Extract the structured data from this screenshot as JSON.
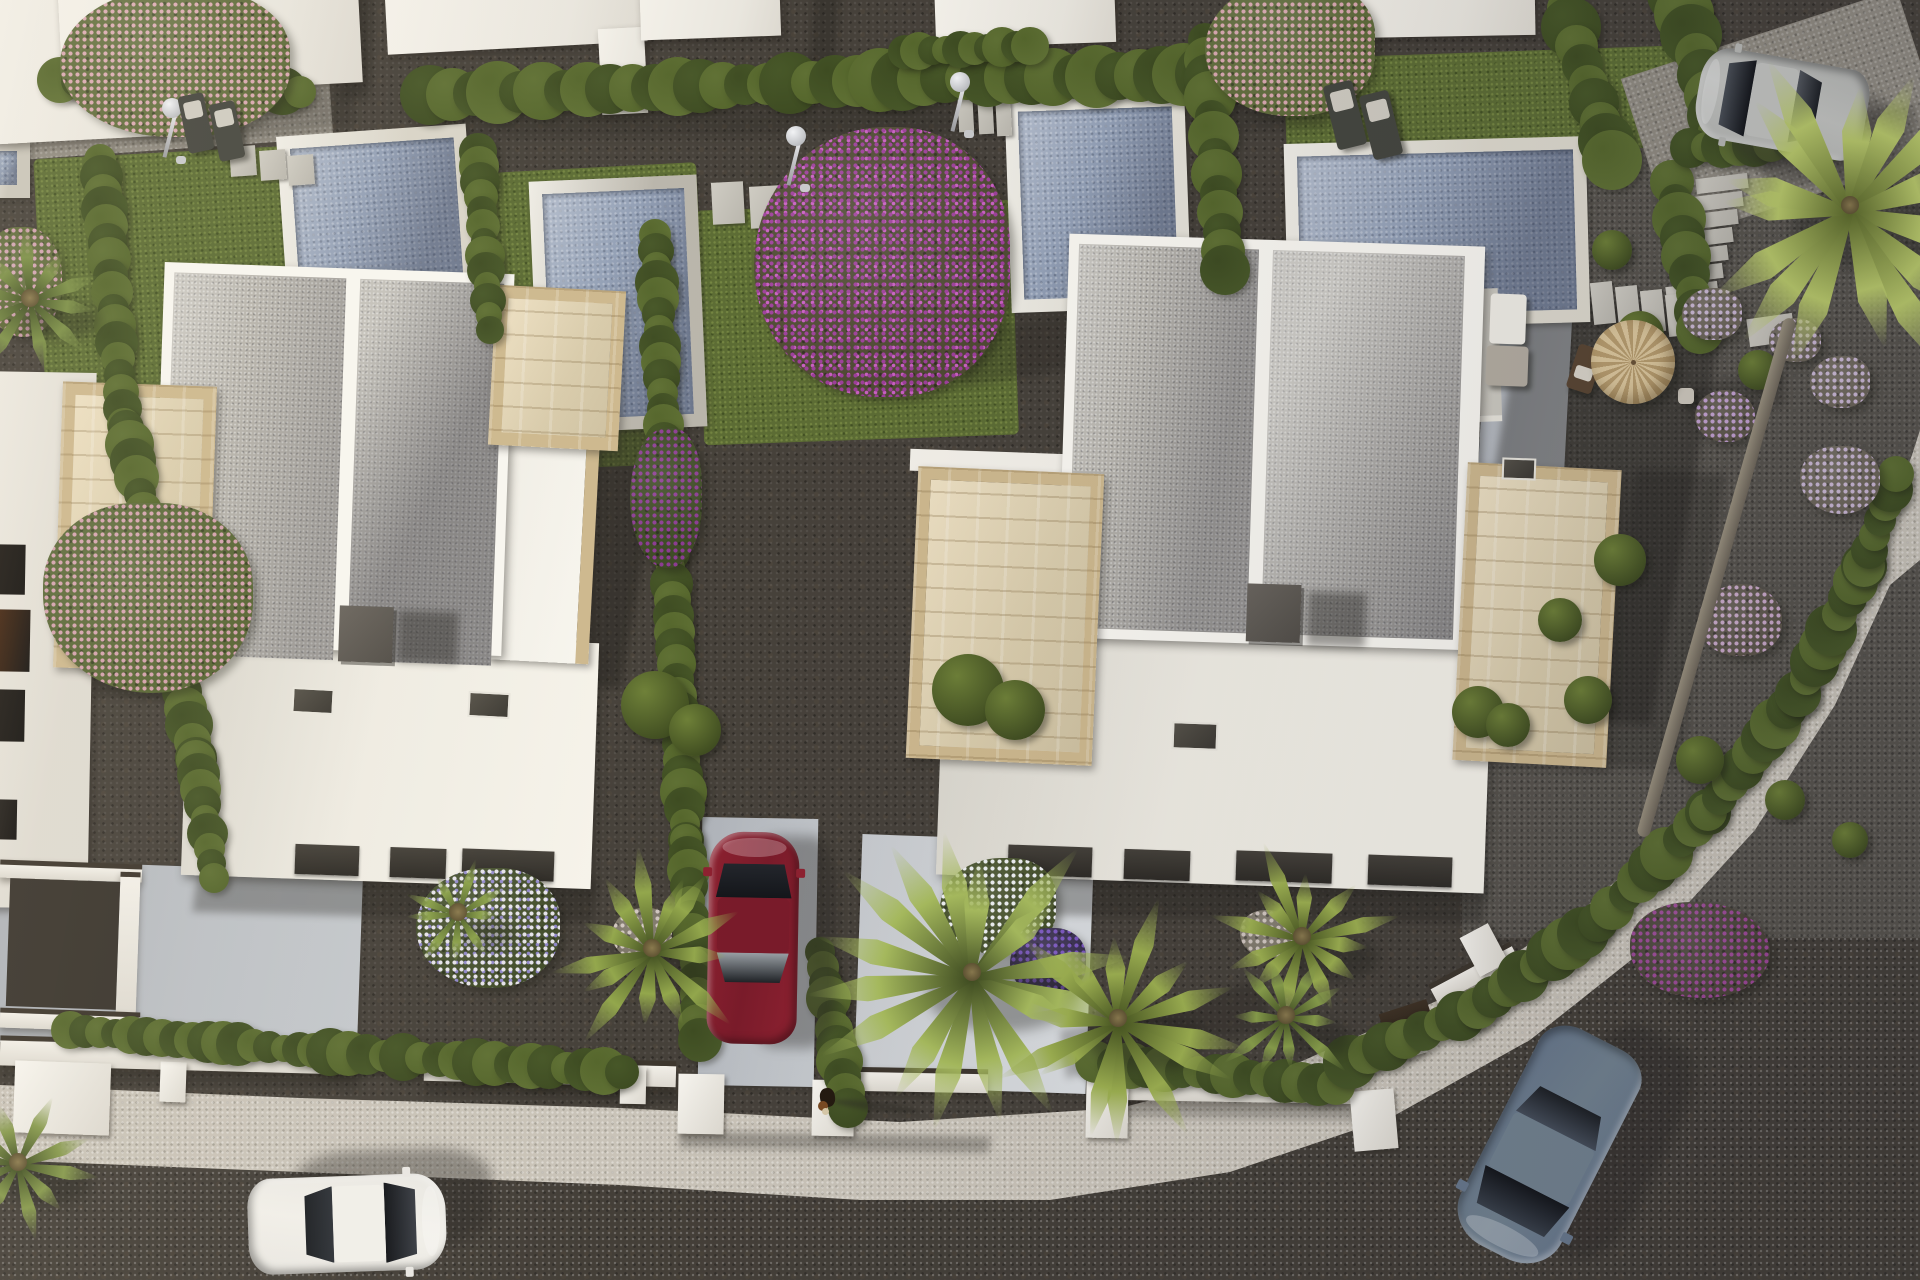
{
  "scene": {
    "title": "aerial-3d-render-of-white-villas-with-pools",
    "width": 1920,
    "height": 1280
  },
  "palette": {
    "gravel_dark": "#46413a",
    "grass": "#5c6c34",
    "road": "#b0aba3",
    "sidewalk": "#c9c3b8",
    "villa_white": "#f8f6f0",
    "roof_gravel": "#b7b4ad",
    "travertine": "#cfba90",
    "pool_water": "#93a0b6",
    "pool_coping": "#d8d4c8",
    "hedge_green": "#4c5a2b",
    "car_red": "#8e2130",
    "car_white": "#e9e7e2",
    "car_blue": "#68788c",
    "car_silver": "#b6b7b3",
    "parasol": "#d2ba8e",
    "chimney": "#57534c"
  },
  "patches": [
    {
      "c": "grass",
      "x": 40,
      "y": 148,
      "w": 420,
      "h": 272,
      "r": -3
    },
    {
      "c": "grass",
      "x": 468,
      "y": 168,
      "w": 235,
      "h": 262,
      "r": -3
    },
    {
      "c": "grass",
      "x": 700,
      "y": 205,
      "w": 315,
      "h": 235,
      "r": -2
    },
    {
      "c": "grass",
      "x": 470,
      "y": 398,
      "w": 205,
      "h": 70,
      "r": -2
    },
    {
      "c": "grass",
      "x": 1288,
      "y": 52,
      "w": 400,
      "h": 272,
      "r": -2
    },
    {
      "c": "grass",
      "x": 1370,
      "y": 358,
      "w": 320,
      "h": 112,
      "r": -2
    },
    {
      "c": "grass",
      "x": 1492,
      "y": 296,
      "w": 95,
      "h": 78,
      "r": -2
    },
    {
      "c": "pale-path",
      "x": -10,
      "y": 42,
      "w": 340,
      "h": 108,
      "r": -4
    },
    {
      "c": "gravel-light",
      "x": 1462,
      "y": 148,
      "w": 470,
      "h": 790,
      "r": 0
    },
    {
      "c": "pale-path",
      "x": 1640,
      "y": 30,
      "w": 290,
      "h": 170,
      "r": -18
    },
    {
      "c": "drive",
      "x": -12,
      "y": 866,
      "w": 372,
      "h": 182,
      "r": 2
    },
    {
      "c": "drive",
      "x": 700,
      "y": 818,
      "w": 116,
      "h": 268,
      "r": 1
    },
    {
      "c": "drive-bright",
      "x": 858,
      "y": 838,
      "w": 232,
      "h": 252,
      "r": 2
    },
    {
      "c": "drive",
      "x": 1478,
      "y": 298,
      "w": 86,
      "h": 350,
      "r": 3
    }
  ],
  "pools": [
    {
      "x": 282,
      "y": 130,
      "w": 190,
      "h": 178,
      "r": -4,
      "coping": "#d8d4c8"
    },
    {
      "x": 534,
      "y": 178,
      "w": 168,
      "h": 252,
      "r": -2.5,
      "coping": "#b9b5ab"
    },
    {
      "x": 1008,
      "y": 96,
      "w": 180,
      "h": 214,
      "r": -2,
      "coping": "#e3e0d6"
    },
    {
      "x": 1286,
      "y": 140,
      "w": 302,
      "h": 186,
      "r": -1.5,
      "coping": "#ddd9cd"
    },
    {
      "x": -18,
      "y": 138,
      "w": 48,
      "h": 60,
      "r": 0,
      "coping": "#c9c5ba"
    }
  ],
  "pool_deck": {
    "x": 1278,
    "y": 292,
    "w": 222,
    "h": 133,
    "r": -2
  },
  "hedges": [
    [
      60,
      80,
      300,
      92,
      20
    ],
    [
      430,
      95,
      880,
      80,
      26
    ],
    [
      880,
      80,
      1335,
      72,
      26
    ],
    [
      905,
      52,
      1030,
      46,
      17
    ],
    [
      1565,
      8,
      1612,
      160,
      24
    ],
    [
      1678,
      -6,
      1722,
      136,
      26
    ],
    [
      1672,
      182,
      1700,
      330,
      22
    ],
    [
      1205,
      40,
      1225,
      270,
      22
    ],
    [
      100,
      160,
      124,
      425,
      19
    ],
    [
      126,
      428,
      196,
      758,
      20
    ],
    [
      196,
      760,
      214,
      878,
      18
    ],
    [
      478,
      152,
      490,
      330,
      17
    ],
    [
      655,
      235,
      668,
      520,
      19
    ],
    [
      668,
      520,
      686,
      840,
      19
    ],
    [
      686,
      840,
      700,
      1040,
      18
    ],
    [
      820,
      952,
      848,
      1108,
      19
    ],
    [
      70,
      1030,
      330,
      1052,
      18
    ],
    [
      330,
      1052,
      622,
      1072,
      21
    ],
    [
      1096,
      1062,
      1336,
      1086,
      21
    ],
    [
      1350,
      1062,
      1478,
      1008,
      22
    ],
    [
      1478,
      1008,
      1598,
      922,
      22
    ],
    [
      1598,
      922,
      1708,
      812,
      22
    ],
    [
      1708,
      812,
      1798,
      694,
      22
    ],
    [
      1798,
      694,
      1864,
      566,
      22
    ],
    [
      1864,
      566,
      1896,
      474,
      20
    ],
    [
      1690,
      148,
      1852,
      140,
      19
    ]
  ],
  "bushes": [
    [
      968,
      690,
      36
    ],
    [
      1015,
      710,
      30
    ],
    [
      655,
      705,
      34
    ],
    [
      695,
      730,
      26
    ],
    [
      1478,
      712,
      26
    ],
    [
      1508,
      725,
      22
    ],
    [
      1588,
      700,
      24
    ],
    [
      1640,
      335,
      24
    ],
    [
      1758,
      370,
      20
    ],
    [
      1620,
      560,
      26
    ],
    [
      1560,
      620,
      22
    ],
    [
      1700,
      760,
      24
    ],
    [
      1785,
      800,
      20
    ],
    [
      1850,
      840,
      18
    ],
    [
      1612,
      250,
      20
    ]
  ],
  "beds": [
    {
      "x": 175,
      "y": 62,
      "rx": 115,
      "ry": 75,
      "base": "#5f6b3a",
      "dot": "#d9a8b0"
    },
    {
      "x": 148,
      "y": 598,
      "rx": 105,
      "ry": 95,
      "base": "#566433",
      "dot": "#d2a0ac"
    },
    {
      "x": 882,
      "y": 262,
      "rx": 128,
      "ry": 135,
      "base": "#4f4a33",
      "dot": "#9d3f9a",
      "dot2": "#c95fc2"
    },
    {
      "x": 666,
      "y": 498,
      "rx": 36,
      "ry": 70,
      "base": "#3e4a26",
      "dot": "#8b3b92"
    },
    {
      "x": 1290,
      "y": 48,
      "rx": 85,
      "ry": 68,
      "base": "#5f6b3a",
      "dot": "#d8a6ae"
    },
    {
      "x": 488,
      "y": 928,
      "rx": 72,
      "ry": 60,
      "base": "#424d2a",
      "dot": "#e6e3ea",
      "dot2": "#8f86c9"
    },
    {
      "x": 998,
      "y": 906,
      "rx": 58,
      "ry": 48,
      "base": "#47522c",
      "dot": "#eef0f2"
    },
    {
      "x": 1048,
      "y": 962,
      "rx": 38,
      "ry": 34,
      "base": "#3a3050",
      "dot": "#7a55c0"
    },
    {
      "x": 1712,
      "y": 314,
      "rx": 30,
      "ry": 26,
      "base": "#6b6458",
      "dot": "#c9b6d2"
    },
    {
      "x": 1795,
      "y": 340,
      "rx": 26,
      "ry": 22,
      "base": "#6b6458",
      "dot": "#c9b6d2"
    },
    {
      "x": 1840,
      "y": 382,
      "rx": 30,
      "ry": 26,
      "base": "#6b6458",
      "dot": "#c9b6d2"
    },
    {
      "x": 1725,
      "y": 416,
      "rx": 30,
      "ry": 26,
      "base": "#5c5549",
      "dot": "#c29fd0"
    },
    {
      "x": 1840,
      "y": 480,
      "rx": 40,
      "ry": 34,
      "base": "#6b6458",
      "dot": "#c9b6d2"
    },
    {
      "x": 1740,
      "y": 620,
      "rx": 42,
      "ry": 36,
      "base": "#5c5549",
      "dot": "#c9a8c8"
    },
    {
      "x": 1700,
      "y": 950,
      "rx": 70,
      "ry": 48,
      "base": "#4a4438",
      "dot": "#9c4796"
    },
    {
      "x": 642,
      "y": 934,
      "rx": 30,
      "ry": 26,
      "base": "#7d7668",
      "dot": "#cfc4bd"
    },
    {
      "x": 1268,
      "y": 934,
      "rx": 28,
      "ry": 24,
      "base": "#7d7668",
      "dot": "#cfc4bd"
    },
    {
      "x": 22,
      "y": 282,
      "rx": 40,
      "ry": 55,
      "base": "#5a6535",
      "dot": "#cf9fae"
    }
  ],
  "palms": [
    {
      "x": 972,
      "y": 972,
      "r": 150,
      "n": 16,
      "c1": "#3f4c20",
      "c2": "#a8bc5e"
    },
    {
      "x": 1118,
      "y": 1018,
      "r": 118,
      "n": 14,
      "c1": "#46541f",
      "c2": "#9db050"
    },
    {
      "x": 652,
      "y": 948,
      "r": 100,
      "n": 13,
      "c1": "#3f4c20",
      "c2": "#93a74c"
    },
    {
      "x": 1850,
      "y": 205,
      "r": 175,
      "n": 15,
      "c1": "#5c6a2a",
      "c2": "#b9c96a",
      "z": 14
    },
    {
      "x": 1302,
      "y": 936,
      "r": 92,
      "n": 12,
      "c1": "#46541f",
      "c2": "#9db050"
    },
    {
      "x": 1286,
      "y": 1015,
      "r": 70,
      "n": 10,
      "c1": "#3f4c20",
      "c2": "#8aa04b"
    },
    {
      "x": 30,
      "y": 298,
      "r": 80,
      "n": 10,
      "c1": "#3c4a21",
      "c2": "#7b8f47"
    },
    {
      "x": 18,
      "y": 1162,
      "r": 85,
      "n": 10,
      "c1": "#3c4a21",
      "c2": "#86994d"
    },
    {
      "x": 458,
      "y": 912,
      "r": 55,
      "n": 9,
      "c1": "#4a5a28",
      "c2": "#8aa04b"
    }
  ],
  "trunk": {
    "x": 1710,
    "y": 308,
    "w": 13,
    "h": 539,
    "rot": 16
  },
  "slabs": [
    [
      230,
      146,
      26,
      30,
      -4
    ],
    [
      260,
      150,
      26,
      30,
      -4
    ],
    [
      288,
      155,
      26,
      30,
      -4
    ],
    [
      712,
      182,
      32,
      42,
      -3
    ],
    [
      750,
      186,
      30,
      42,
      -3
    ],
    [
      958,
      86,
      15,
      46,
      -3
    ],
    [
      978,
      88,
      15,
      46,
      -3
    ],
    [
      996,
      90,
      15,
      46,
      -3
    ],
    [
      1696,
      176,
      52,
      15,
      -7
    ],
    [
      1691,
      194,
      52,
      15,
      -7
    ],
    [
      1686,
      212,
      52,
      15,
      -7
    ],
    [
      1681,
      230,
      52,
      15,
      -7
    ],
    [
      1676,
      248,
      52,
      15,
      -7
    ],
    [
      1671,
      266,
      52,
      15,
      -7
    ],
    [
      1666,
      284,
      52,
      15,
      -7
    ],
    [
      1592,
      282,
      22,
      42,
      -6
    ],
    [
      1617,
      286,
      22,
      42,
      -6
    ],
    [
      1642,
      290,
      22,
      42,
      -6
    ],
    [
      1667,
      294,
      22,
      42,
      -6
    ],
    [
      1748,
      316,
      46,
      28,
      -8
    ]
  ],
  "walls": [
    [
      0,
      1040,
      352,
      30,
      1.5
    ],
    [
      424,
      1058,
      252,
      26,
      1.5
    ],
    [
      846,
      1068,
      142,
      24,
      1
    ],
    [
      1122,
      1076,
      232,
      26,
      1
    ],
    [
      1342,
      1040,
      84,
      24,
      -16
    ],
    [
      1428,
      962,
      92,
      22,
      -28
    ],
    [
      0,
      862,
      142,
      18,
      2
    ],
    [
      118,
      872,
      20,
      150,
      2
    ],
    [
      0,
      1010,
      140,
      20,
      2
    ]
  ],
  "piers": [
    [
      14,
      1062,
      96,
      72,
      2
    ],
    [
      160,
      1062,
      26,
      40,
      2
    ],
    [
      620,
      1066,
      26,
      38,
      1
    ],
    [
      678,
      1074,
      46,
      60,
      1
    ],
    [
      812,
      1080,
      42,
      56,
      1
    ],
    [
      1086,
      1080,
      42,
      58,
      1
    ],
    [
      1352,
      1090,
      44,
      60,
      -5
    ],
    [
      1468,
      928,
      32,
      44,
      -28
    ]
  ],
  "gate": {
    "x": 1382,
    "y": 1006,
    "w": 50,
    "h": 30,
    "rot": -18,
    "color": "#3f3224"
  },
  "showers": [
    [
      162,
      104
    ],
    [
      786,
      132
    ],
    [
      950,
      78
    ]
  ],
  "furniture": [
    {
      "t": "lounger",
      "x": 183,
      "y": 94,
      "w": 26,
      "h": 58,
      "rot": -12
    },
    {
      "t": "lounger",
      "x": 214,
      "y": 102,
      "w": 26,
      "h": 58,
      "rot": -12
    },
    {
      "t": "lounger",
      "x": 1330,
      "y": 82,
      "w": 30,
      "h": 66,
      "rot": -14
    },
    {
      "t": "lounger",
      "x": 1366,
      "y": 92,
      "w": 30,
      "h": 66,
      "rot": -14
    },
    {
      "t": "chair",
      "x": 1572,
      "y": 346,
      "w": 26,
      "h": 46,
      "rot": 18
    },
    {
      "t": "table",
      "x": 1678,
      "y": 388,
      "w": 16,
      "h": 16,
      "rot": 0
    },
    {
      "t": "parasol",
      "x": 1591,
      "y": 320,
      "w": 84,
      "h": 84,
      "rot": 0
    },
    {
      "t": "sofa",
      "x": 1490,
      "y": 294,
      "w": 36,
      "h": 50,
      "rot": 2
    },
    {
      "t": "seat",
      "x": 1486,
      "y": 346,
      "w": 42,
      "h": 40,
      "rot": 2
    }
  ],
  "cars": [
    {
      "name": "car-white",
      "cx": 347,
      "cy": 1224,
      "w": 96,
      "h": 198,
      "rot": 88,
      "body": "#e9e7e2",
      "roof": "#f1efe9",
      "glassF": "#3a3e45",
      "glassR": "#2f3339",
      "sdx": 46,
      "sdy": -26
    },
    {
      "name": "car-red",
      "cx": 753,
      "cy": 938,
      "w": 90,
      "h": 212,
      "rot": 1,
      "body": "#8e2130",
      "roof": "#7a1b2a",
      "glassF": "#23262c",
      "glassR": "#9aa0a5",
      "sdx": 40,
      "sdy": 4
    },
    {
      "name": "car-blue",
      "cx": 1548,
      "cy": 1146,
      "w": 112,
      "h": 238,
      "rot": 207,
      "body": "#68788c",
      "roof": "#72828f",
      "glassF": "#39404a",
      "glassR": "#454d59",
      "sdx": 60,
      "sdy": -4
    },
    {
      "name": "car-silver",
      "cx": 1782,
      "cy": 104,
      "w": 92,
      "h": 170,
      "rot": -80,
      "body": "#b6b7b3",
      "roof": "#c3c4c0",
      "glassF": "#4a4f56",
      "glassR": "#53575d",
      "sdx": 34,
      "sdy": 28
    }
  ],
  "dog": {
    "x": 820,
    "y": 1088
  },
  "shadows": [
    [
      505,
      295,
      150,
      390,
      4,
      0.4
    ],
    [
      195,
      875,
      400,
      42,
      1.5,
      0.33
    ],
    [
      1488,
      300,
      200,
      420,
      4,
      0.38
    ],
    [
      1612,
      470,
      90,
      300,
      3,
      0.28
    ],
    [
      945,
      878,
      540,
      40,
      1,
      0.32
    ],
    [
      62,
      668,
      160,
      30,
      2,
      0.28
    ],
    [
      165,
      -5,
      40,
      140,
      -3,
      0.33
    ],
    [
      342,
      -10,
      30,
      110,
      -3,
      0.3
    ],
    [
      812,
      -15,
      26,
      80,
      -2,
      0.3
    ],
    [
      1262,
      -12,
      24,
      70,
      -2,
      0.3
    ],
    [
      430,
      108,
      900,
      26,
      -0.5,
      0.22
    ],
    [
      960,
      318,
      170,
      55,
      -10,
      0.26
    ],
    [
      235,
      95,
      120,
      38,
      -8,
      0.22
    ],
    [
      1690,
      378,
      95,
      36,
      -10,
      0.26
    ],
    [
      1760,
      120,
      160,
      60,
      -12,
      0.28
    ],
    [
      1060,
      1005,
      210,
      48,
      -14,
      0.26
    ],
    [
      0,
      1068,
      360,
      18,
      1.5,
      0.26
    ],
    [
      424,
      1084,
      260,
      16,
      1.5,
      0.26
    ],
    [
      680,
      1134,
      310,
      16,
      1,
      0.3
    ],
    [
      1090,
      1102,
      270,
      16,
      1,
      0.26
    ]
  ],
  "top_blocks": [
    [
      -15,
      -15,
      185,
      155,
      -3
    ],
    [
      60,
      -25,
      300,
      115,
      -3
    ],
    [
      386,
      -18,
      260,
      66,
      -3
    ],
    [
      600,
      28,
      46,
      86,
      -3
    ],
    [
      640,
      -30,
      140,
      68,
      -2
    ],
    [
      935,
      -25,
      180,
      70,
      -2
    ],
    [
      1285,
      -25,
      250,
      62,
      -1
    ]
  ],
  "neighbor_slots": [
    [
      0,
      545,
      44,
      50,
      "#241f1a"
    ],
    [
      0,
      610,
      50,
      62,
      "#5a3014"
    ],
    [
      0,
      690,
      46,
      52,
      "#26211c"
    ],
    [
      0,
      800,
      40,
      40,
      "#35302a"
    ]
  ]
}
